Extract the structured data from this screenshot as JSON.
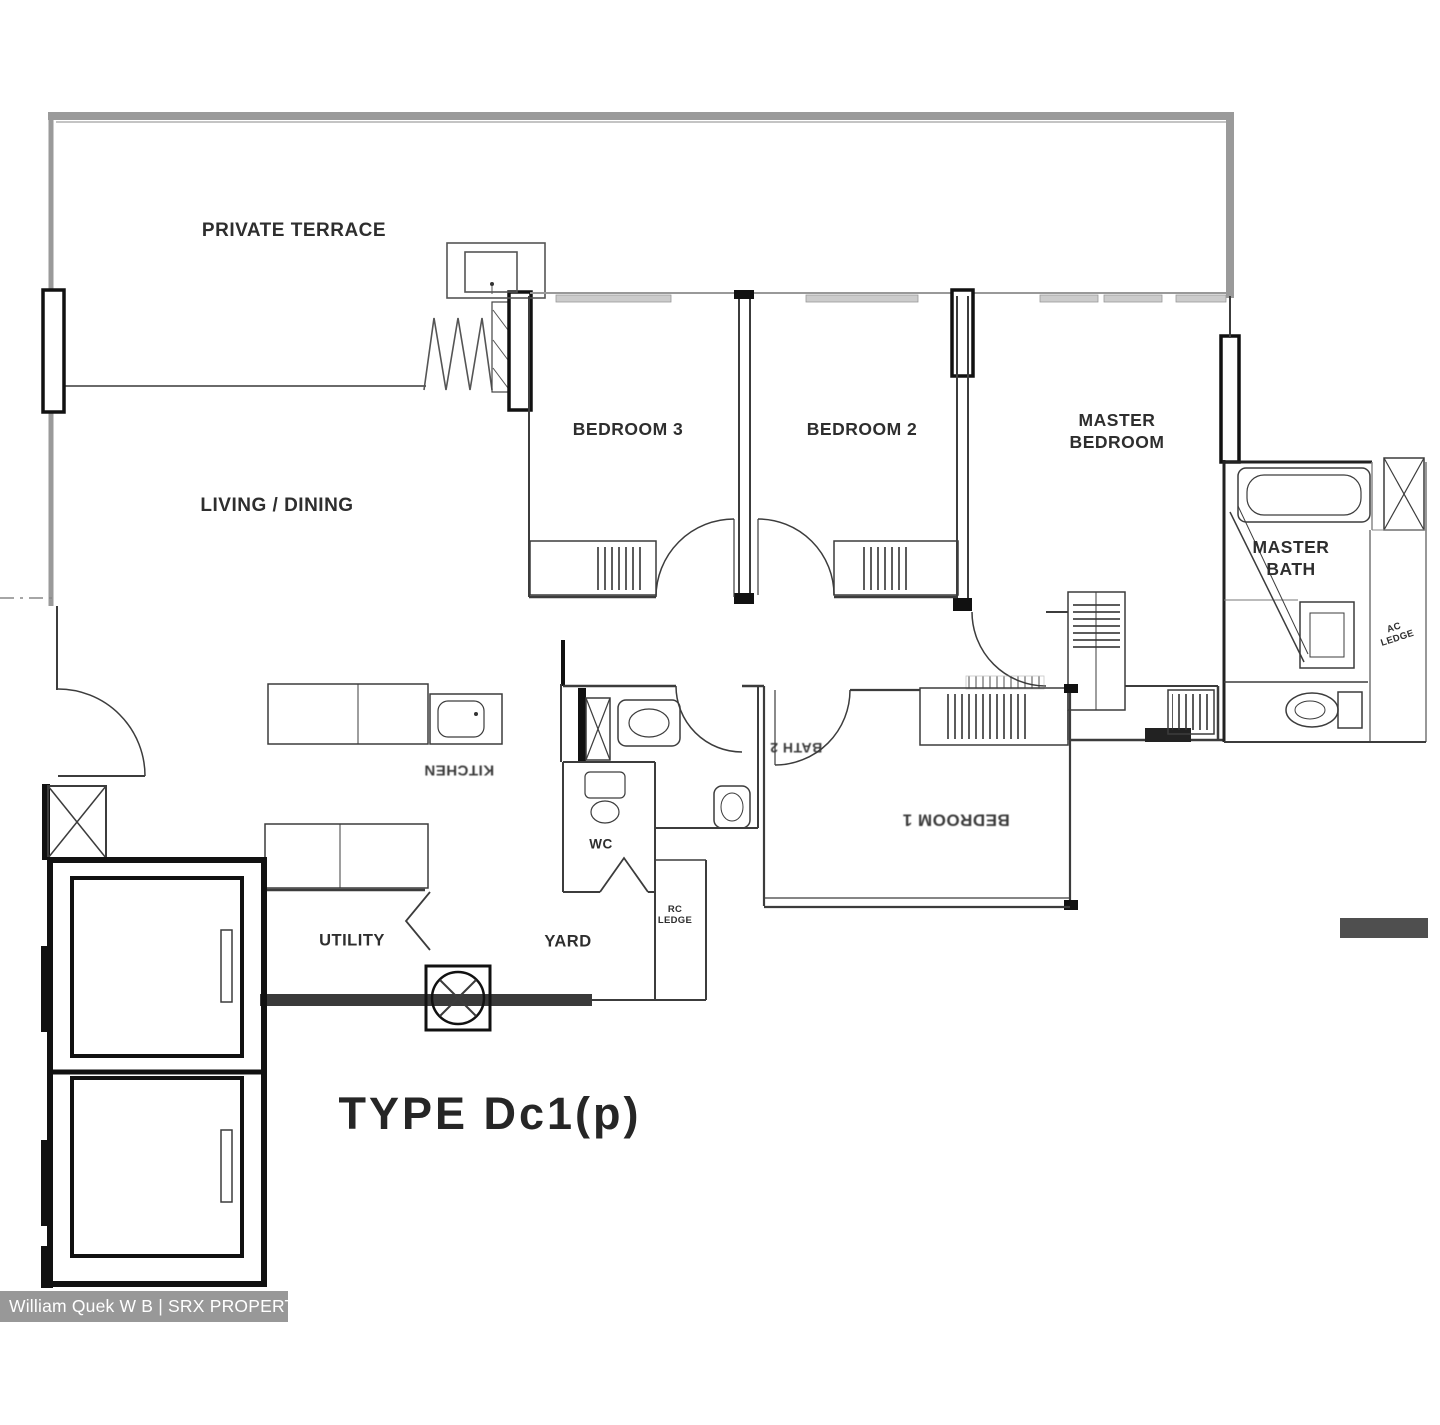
{
  "plan": {
    "type_title": "TYPE Dc1(p)",
    "watermark": "William Quek W B | SRX PROPERTY",
    "labels": {
      "private_terrace": "PRIVATE TERRACE",
      "living_dining": "LIVING / DINING",
      "bedroom3": "BEDROOM 3",
      "bedroom2": "BEDROOM 2",
      "master_l1": "MASTER",
      "master_l2": "BEDROOM",
      "mbath_l1": "MASTER",
      "mbath_l2": "BATH",
      "ac_l1": "AC",
      "ac_l2": "LEDGE",
      "kitchen": "KITCHEN",
      "bath2": "BATH 2",
      "bedroom1": "BEDROOM 1",
      "wc": "WC",
      "rc_l1": "RC",
      "rc_l2": "LEDGE",
      "utility": "UTILITY",
      "yard": "YARD"
    },
    "colors": {
      "outer_wall_gray": "#9a9a9a",
      "wall_dark": "#3c3c3c",
      "wall_black": "#161616",
      "window_fill": "#cccccc",
      "watermark_bg": "#8f8f8f",
      "watermark_text": "#ffffff"
    }
  }
}
